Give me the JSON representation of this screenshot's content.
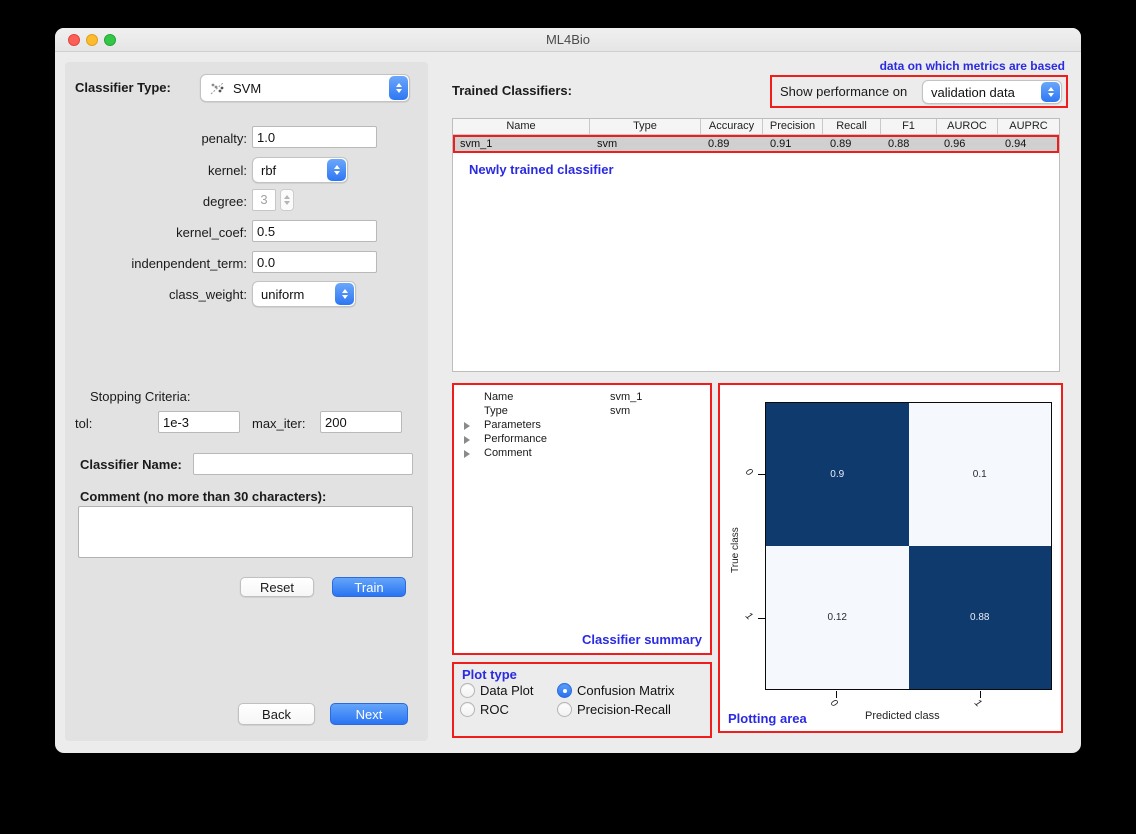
{
  "window": {
    "title": "ML4Bio"
  },
  "left_panel": {
    "classifier_type_label": "Classifier Type:",
    "classifier_type_value": "SVM",
    "fields": {
      "penalty_label": "penalty:",
      "penalty_value": "1.0",
      "kernel_label": "kernel:",
      "kernel_value": "rbf",
      "degree_label": "degree:",
      "degree_value": "3",
      "kernel_coef_label": "kernel_coef:",
      "kernel_coef_value": "0.5",
      "independent_term_label": "indenpendent_term:",
      "independent_term_value": "0.0",
      "class_weight_label": "class_weight:",
      "class_weight_value": "uniform"
    },
    "stopping_criteria_label": "Stopping Criteria:",
    "tol_label": "tol:",
    "tol_value": "1e-3",
    "max_iter_label": "max_iter:",
    "max_iter_value": "200",
    "classifier_name_label": "Classifier Name:",
    "classifier_name_value": "",
    "comment_label": "Comment (no more than 30 characters):",
    "comment_value": "",
    "reset_button": "Reset",
    "train_button": "Train",
    "back_button": "Back",
    "next_button": "Next"
  },
  "right_panel": {
    "trained_classifiers_label": "Trained Classifiers:",
    "metrics_note": "data on which metrics are based",
    "show_performance_label": "Show performance on",
    "show_performance_value": "validation data",
    "table": {
      "headers": [
        "Name",
        "Type",
        "Accuracy",
        "Precision",
        "Recall",
        "F1",
        "AUROC",
        "AUPRC"
      ],
      "rows": [
        [
          "svm_1",
          "svm",
          "0.89",
          "0.91",
          "0.89",
          "0.88",
          "0.96",
          "0.94"
        ]
      ]
    },
    "newly_trained_note": "Newly trained classifier",
    "summary": {
      "items": [
        {
          "label": "Name",
          "value": "svm_1",
          "expandable": false
        },
        {
          "label": "Type",
          "value": "svm",
          "expandable": false
        },
        {
          "label": "Parameters",
          "value": "",
          "expandable": true
        },
        {
          "label": "Performance",
          "value": "",
          "expandable": true
        },
        {
          "label": "Comment",
          "value": "",
          "expandable": true
        }
      ],
      "caption": "Classifier summary"
    },
    "plot_type": {
      "caption": "Plot type",
      "options": [
        {
          "label": "Data Plot",
          "selected": false
        },
        {
          "label": "Confusion Matrix",
          "selected": true
        },
        {
          "label": "ROC",
          "selected": false
        },
        {
          "label": "Precision-Recall",
          "selected": false
        }
      ]
    },
    "plotting_caption": "Plotting area"
  },
  "chart_data": {
    "type": "heatmap",
    "title": "",
    "xlabel": "Predicted class",
    "ylabel": "True class",
    "x_ticks": [
      "0",
      "1"
    ],
    "y_ticks": [
      "0",
      "1"
    ],
    "matrix": [
      [
        0.9,
        0.1
      ],
      [
        0.12,
        0.88
      ]
    ],
    "cell_labels": [
      [
        "0.9",
        "0.1"
      ],
      [
        "0.12",
        "0.88"
      ]
    ],
    "colors": {
      "high": "#0f3a6d",
      "low": "#f5f9fe"
    },
    "legend": "none",
    "grid": false
  },
  "colors": {
    "accent_blue": "#2d77f3",
    "label_blue": "#2a2ae2",
    "annotation_red": "#f01d1d",
    "selected_row_gray": "#d0d0d0"
  }
}
